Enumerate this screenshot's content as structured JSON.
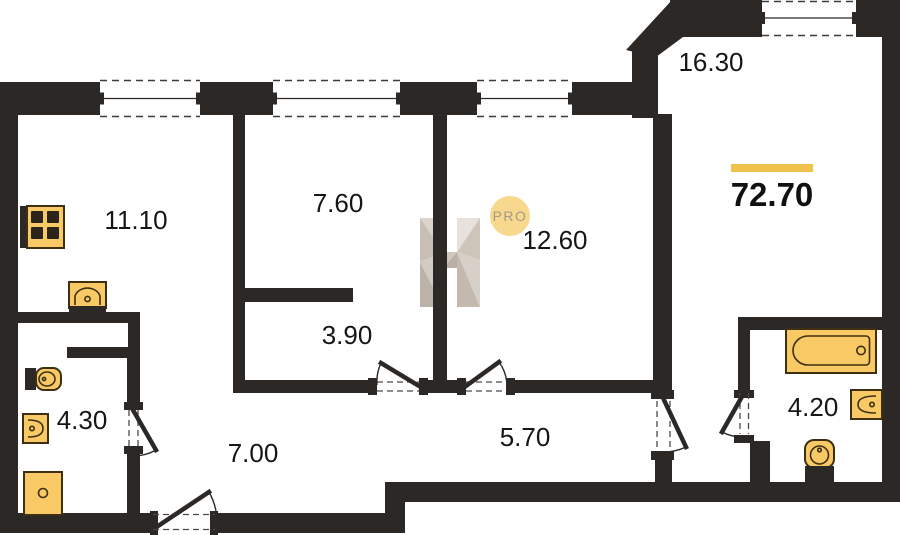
{
  "floor_plan": {
    "total_area": {
      "value": "72.70"
    },
    "rooms": [
      {
        "name": "kitchen",
        "area": "11.10"
      },
      {
        "name": "room-1",
        "area": "7.60"
      },
      {
        "name": "room-2",
        "area": "12.60"
      },
      {
        "name": "living-room",
        "area": "16.30"
      },
      {
        "name": "wardrobe",
        "area": "3.90"
      },
      {
        "name": "bathroom-1",
        "area": "4.30"
      },
      {
        "name": "hallway",
        "area": "7.00"
      },
      {
        "name": "corridor",
        "area": "5.70"
      },
      {
        "name": "bathroom-2",
        "area": "4.20"
      }
    ],
    "logo": {
      "text": "PRO"
    },
    "watermark_letter": "H",
    "colors": {
      "wall": "#2b2826",
      "fixture_fill": "#f8c964",
      "fixture_stroke": "#3d3012",
      "accent_yellow": "#f0c24c",
      "logo_circle": "#f7d88c",
      "logo_text": "#a49b8d",
      "label_text": "#161616",
      "watermark_light": "#e6e1da",
      "watermark_mid": "#cfc8bf",
      "watermark_dark": "#b7ada1"
    }
  }
}
